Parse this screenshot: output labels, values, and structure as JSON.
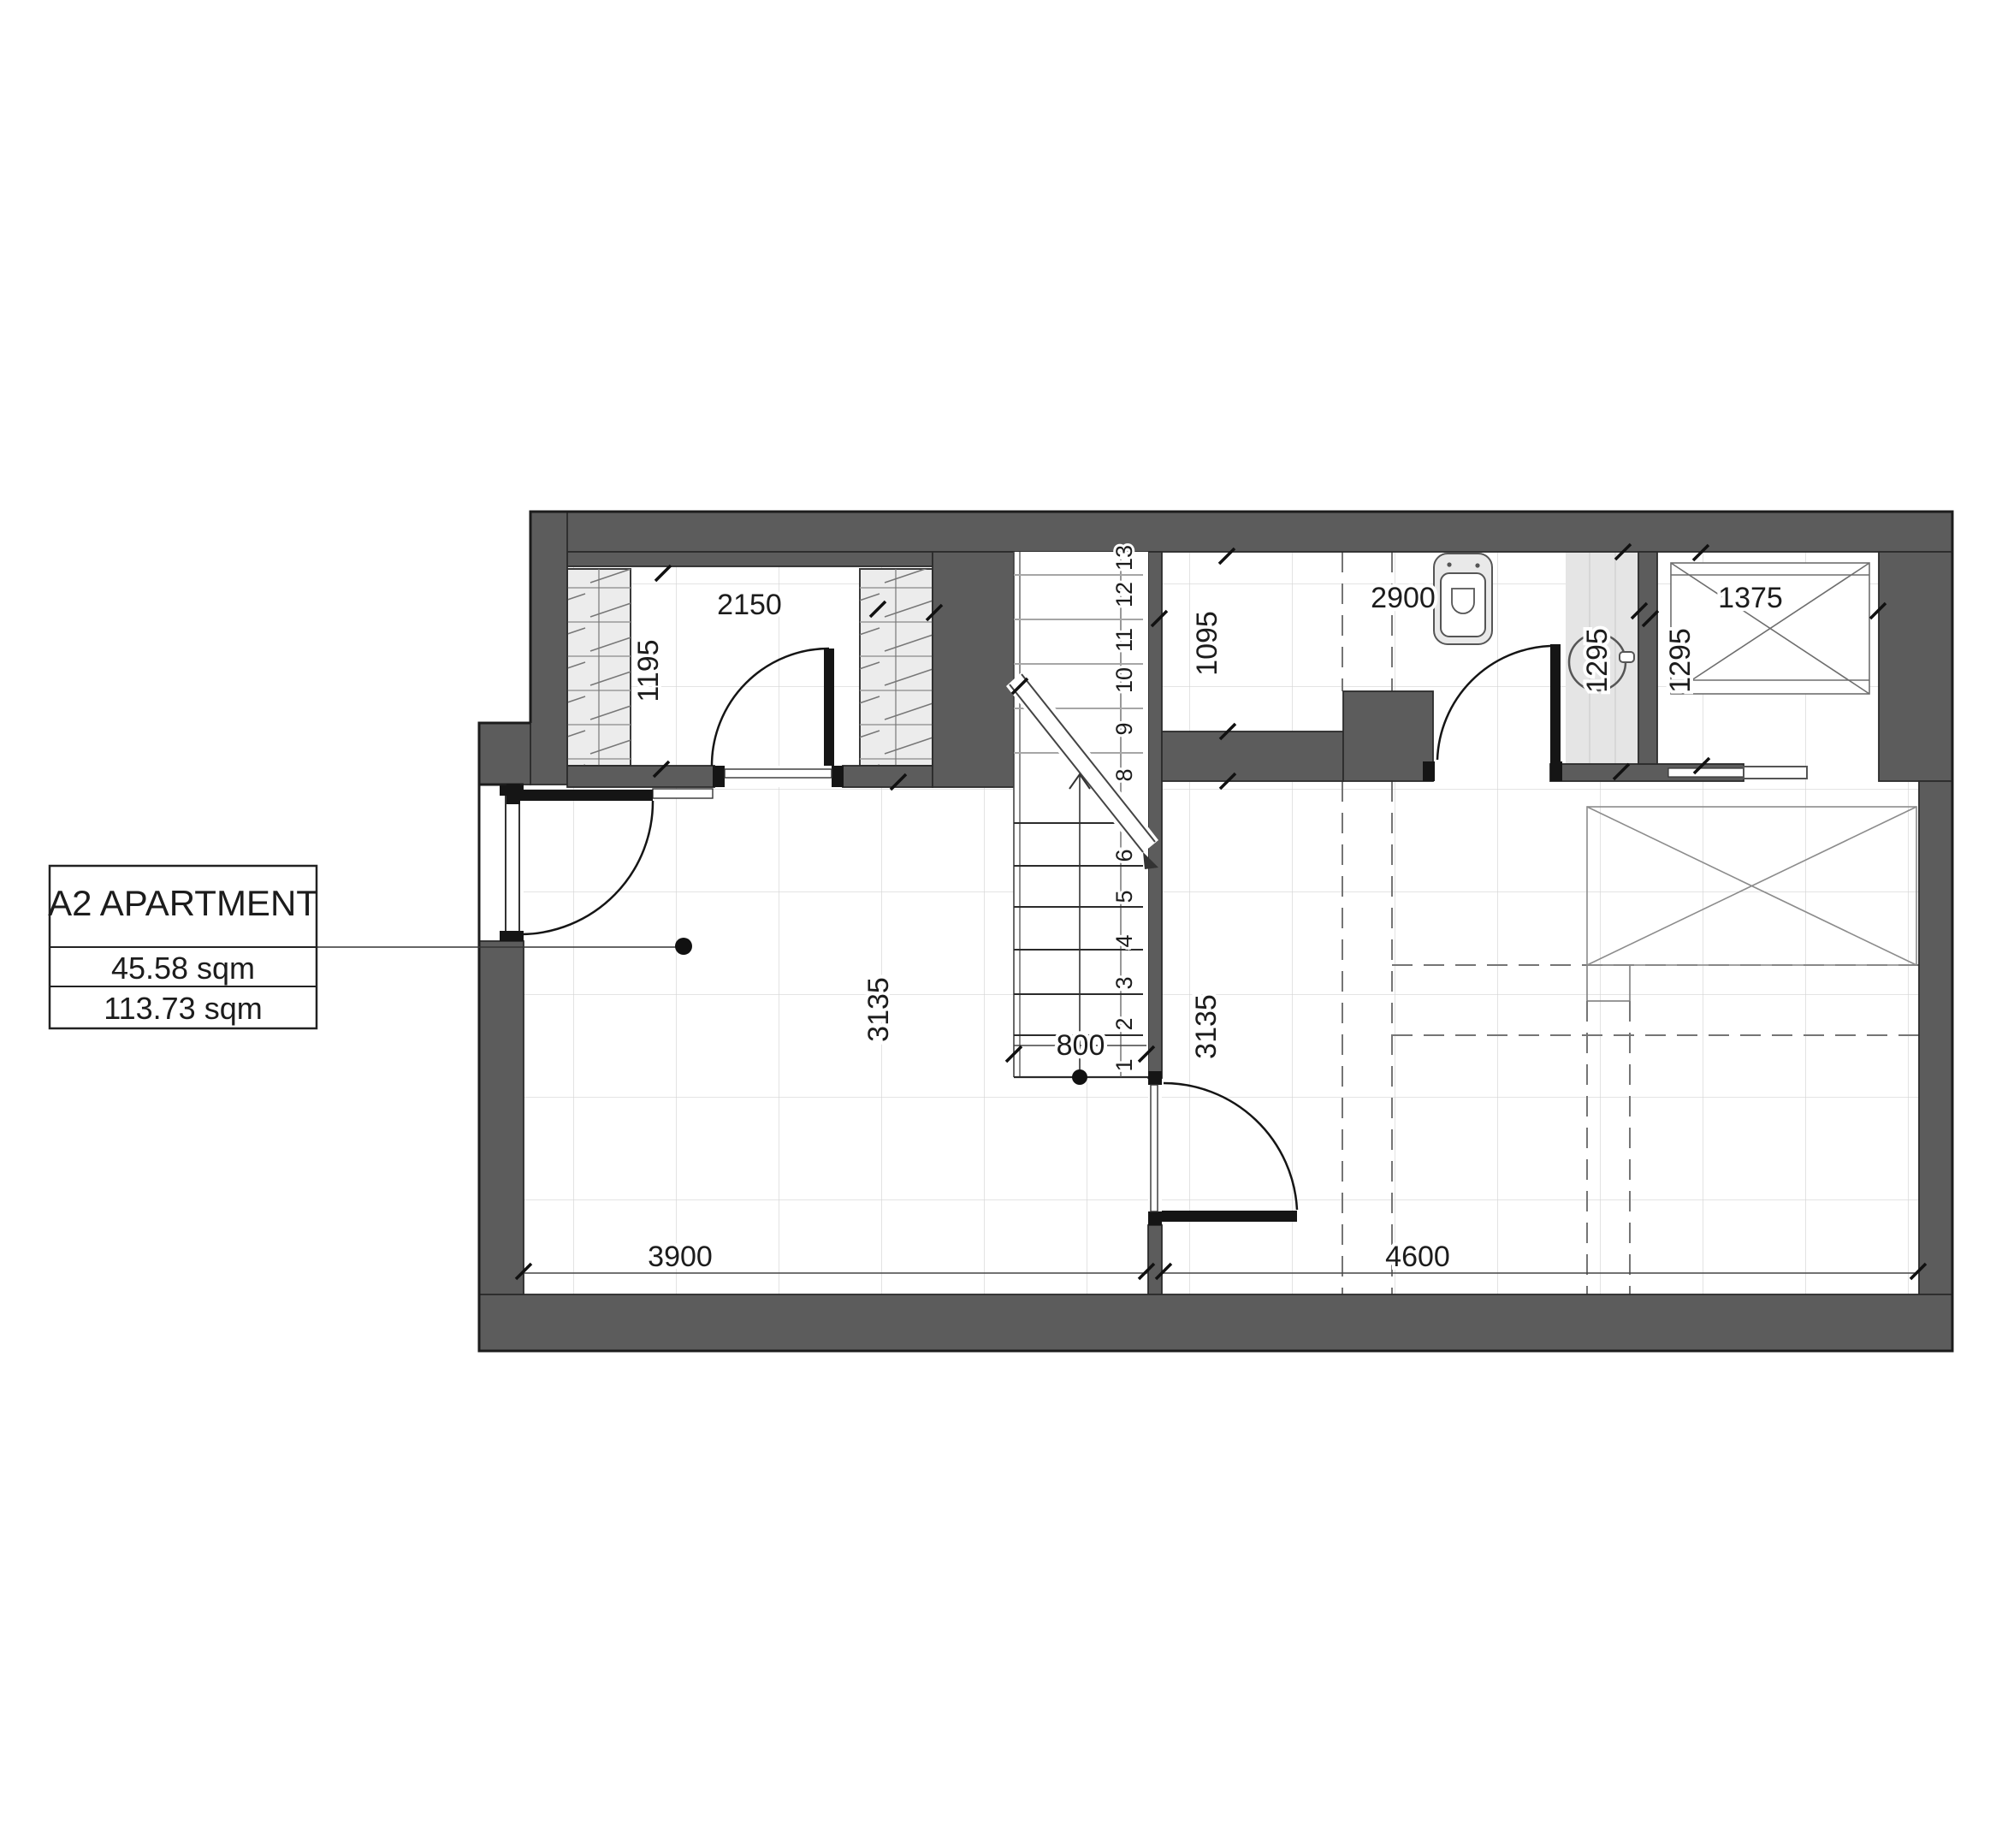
{
  "title_block": {
    "title": "A2 APARTMENT",
    "area_1": "45.58 sqm",
    "area_2": "113.73 sqm"
  },
  "dimensions": {
    "closet_width": "2150",
    "closet_depth": "1195",
    "bath_left_depth": "1095",
    "bath_width": "2900",
    "shower_depth": "1295",
    "niche_depth": "1295",
    "shaft_width": "1375",
    "stair_width": "800",
    "left_room_depth": "3135",
    "right_room_depth": "3135",
    "left_room_width": "3900",
    "right_room_width": "4600"
  },
  "stairs": {
    "lower_steps": [
      "1",
      "2",
      "3",
      "4",
      "5",
      "6"
    ],
    "upper_steps": [
      "8",
      "9",
      "10",
      "11",
      "12",
      "13"
    ]
  },
  "colors": {
    "wall": "#5c5c5c",
    "outline": "#1c1c1c",
    "fixture_fill": "#e9e9e9",
    "shower_strip": "#e5e5e5",
    "grid": "#d4d4d4",
    "dashed_projection": "#757575",
    "stair_upper_flight": "#a6a6a6"
  }
}
